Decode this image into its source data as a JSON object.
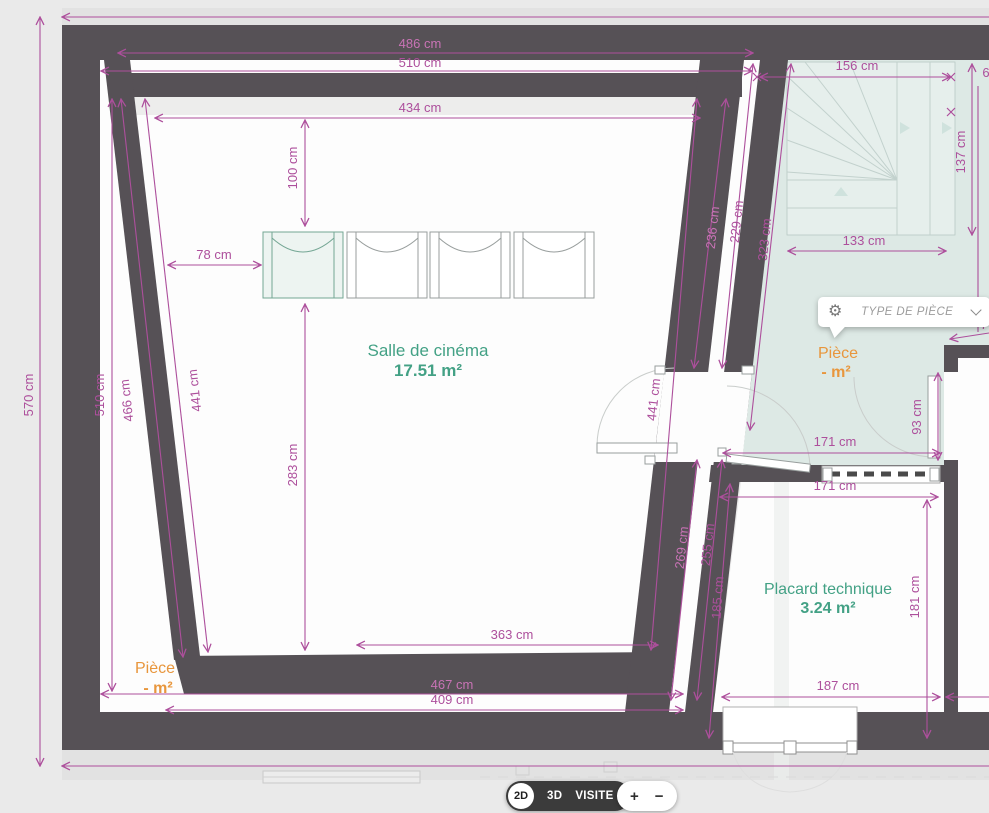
{
  "colors": {
    "wall": "#565156",
    "dimension_accent": "#ad4f9c",
    "hall_teal": "#dde9e5",
    "label_green": "#43a185",
    "label_orange": "#e8963c",
    "toolbar_dark": "#3b3b3b"
  },
  "rooms": [
    {
      "name": "Salle de cinéma",
      "area": "17.51 m²"
    },
    {
      "name": "Pièce",
      "area": "- m²"
    },
    {
      "name": "Placard technique",
      "area": "3.24 m²"
    },
    {
      "name": "Pièce",
      "area": "- m²"
    }
  ],
  "dims": {
    "outer_left": "570 cm",
    "top_a": "486 cm",
    "top_b": "510 cm",
    "top_c": "434 cm",
    "seat_offset": "100 cm",
    "seat_width": "78 cm",
    "left_a": "510 cm",
    "left_b": "466 cm",
    "left_c": "441 cm",
    "mid_v": "283 cm",
    "bottom_a": "363 cm",
    "right_c": "441 cm",
    "bottom_b": "467 cm",
    "bottom_c": "409 cm",
    "wall_a": "236 cm",
    "wall_b": "229 cm",
    "wall_c": "323 cm",
    "stairs_w": "156 cm",
    "stairs_h": "137 cm",
    "stairs_b": "133 cm",
    "hall_w": "171 cm",
    "placard_w": "171 cm",
    "door_h": "93 cm",
    "placard_h": "181 cm",
    "placard_b": "187 cm",
    "placard_l": "185 cm",
    "wall_d": "269 cm",
    "wall_e": "255 cm",
    "cut_a": "6",
    "cut_b": "7"
  },
  "popup": {
    "label": "TYPE DE PIÈCE",
    "gear_icon": "⚙"
  },
  "toolbar": {
    "mode_2d": "2D",
    "mode_3d": "3D",
    "visite": "VISITE",
    "zoom_in": "+",
    "zoom_out": "−"
  }
}
